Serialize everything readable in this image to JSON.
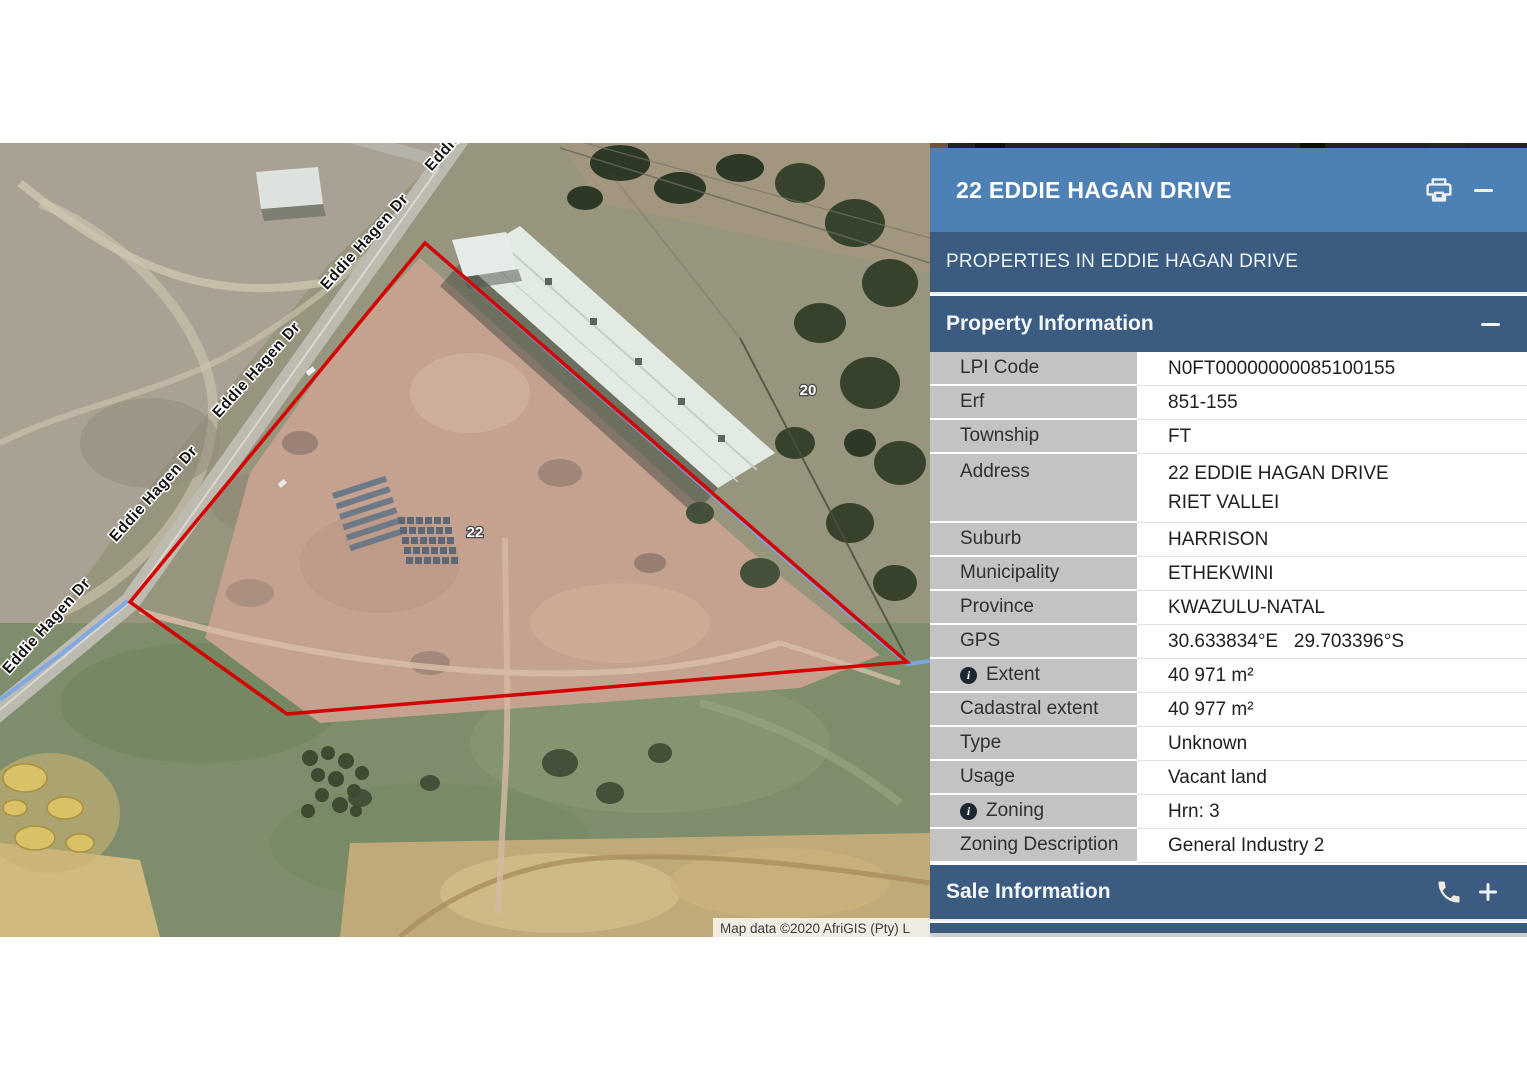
{
  "colors": {
    "header_blue": "#4d80b5",
    "bar_dark_blue": "#3b5c80",
    "label_cell_grey": "#c3c3c3",
    "parcel_red": "#d40000",
    "street_highlight_blue": "#7ba6e8"
  },
  "panel": {
    "title": "22 EDDIE HAGAN DRIVE",
    "subtitle": "PROPERTIES IN EDDIE HAGAN DRIVE",
    "property_section_label": "Property Information",
    "sale_section_label": "Sale Information",
    "rows": [
      {
        "label": "LPI Code",
        "value": "N0FT00000000085100155"
      },
      {
        "label": "Erf",
        "value": "851-155"
      },
      {
        "label": "Township",
        "value": "FT"
      },
      {
        "label": "Address",
        "lines": [
          "22 EDDIE HAGAN DRIVE",
          "RIET VALLEI"
        ]
      },
      {
        "label": "Suburb",
        "value": "HARRISON"
      },
      {
        "label": "Municipality",
        "value": "ETHEKWINI"
      },
      {
        "label": "Province",
        "value": "KWAZULU-NATAL"
      },
      {
        "label": "GPS",
        "value": "30.633834°E   29.703396°S"
      },
      {
        "label": "Extent",
        "value": "40 971 m²",
        "info": true
      },
      {
        "label": "Cadastral extent",
        "value": "40 977 m²"
      },
      {
        "label": "Type",
        "value": "Unknown"
      },
      {
        "label": "Usage",
        "value": "Vacant land"
      },
      {
        "label": "Zoning",
        "value": "Hrn: 3",
        "info": true
      },
      {
        "label": "Zoning Description",
        "value": "General Industry 2"
      }
    ],
    "icons": {
      "print": "print-icon",
      "collapse": "minus-icon",
      "phone": "phone-icon",
      "expand": "plus-icon"
    }
  },
  "map": {
    "street_label": "Eddie Hagen Dr",
    "street_label_partial": "Eddie H",
    "house_number_22": "22",
    "house_number_20": "20",
    "attribution": "Map data ©2020 AfriGIS (Pty) L",
    "parcel_points": "425,100 795,422 907,519 287,571 130,459",
    "street_highlight_points_road": "128,458 60,512 0,557",
    "street_highlight_points_boundary": "425,100 795,424 908,521 930,518"
  }
}
